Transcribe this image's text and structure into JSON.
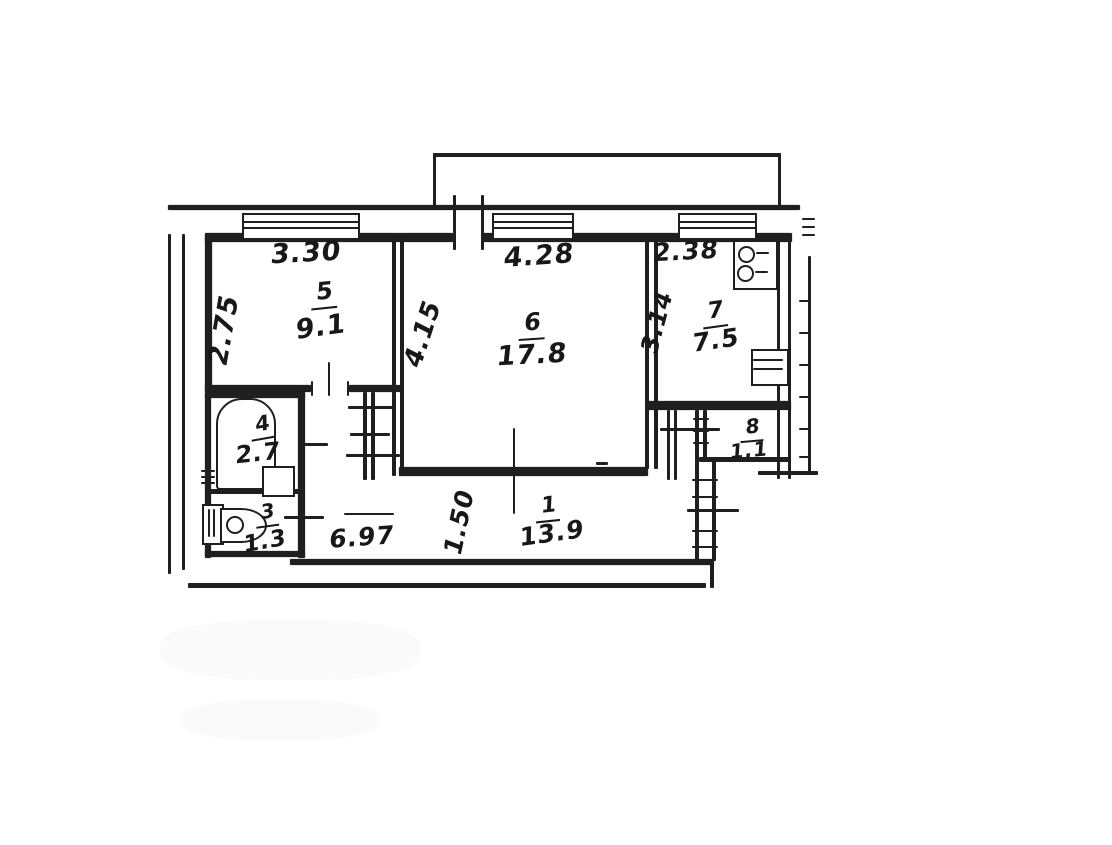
{
  "plan_title": "apartment-floor-plan",
  "ink_color": "#242424",
  "paper_color": "#ffffff",
  "rooms": [
    {
      "number": "5",
      "area": "9.1",
      "width": "3.30",
      "depth": "2.75"
    },
    {
      "number": "6",
      "area": "17.8",
      "width": "4.28",
      "depth": "4.15"
    },
    {
      "number": "7",
      "area": "7.5",
      "width": "2.38",
      "depth": "3.14"
    },
    {
      "number": "4",
      "area": "2.7"
    },
    {
      "number": "3",
      "area": "1.3"
    },
    {
      "number": "1",
      "area": "13.9",
      "width": "6.97",
      "depth": "1.50"
    },
    {
      "number": "8",
      "area": "1.1"
    }
  ],
  "fixtures": [
    "bathtub",
    "wash-basin",
    "toilet",
    "gas-stove",
    "kitchen-sink"
  ],
  "features": [
    "balcony",
    "three-windows",
    "entry-hatched-wall"
  ]
}
